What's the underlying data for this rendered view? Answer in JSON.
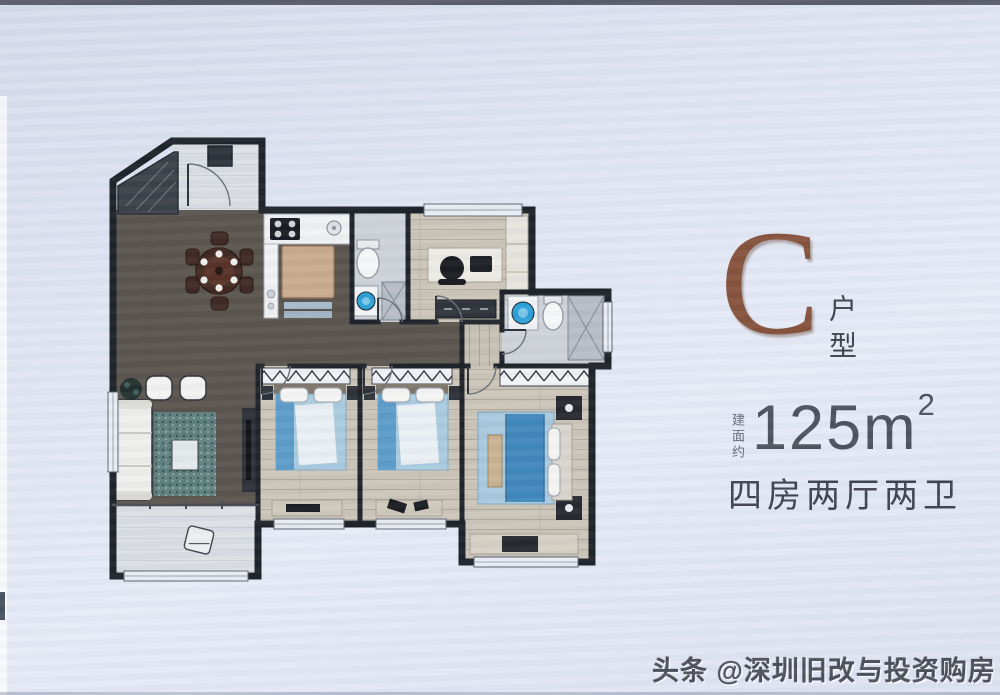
{
  "unit": {
    "type_letter": "C",
    "type_label": "户型",
    "area_prefix": "建面约",
    "area_value": "125m",
    "area_exponent": "2",
    "layout_label": "四房两厅两卫"
  },
  "watermark": {
    "text": "头条 @深圳旧改与投资购房"
  },
  "colors": {
    "background": "#e2e6f3",
    "accent_letter_brown": "#85513a",
    "heading_text": "#3d414c",
    "area_text": "#4b505b",
    "muted_text": "#646976",
    "watermark_text": "#4b4e58",
    "wall": "#1b2026",
    "floor_dark": "#59524c",
    "floor_wood": "#cbc4b8",
    "floor_tile": "#d8dbe0",
    "bed_blue": "#4a8fc0",
    "fixture_blue": "#2a9fd6"
  }
}
